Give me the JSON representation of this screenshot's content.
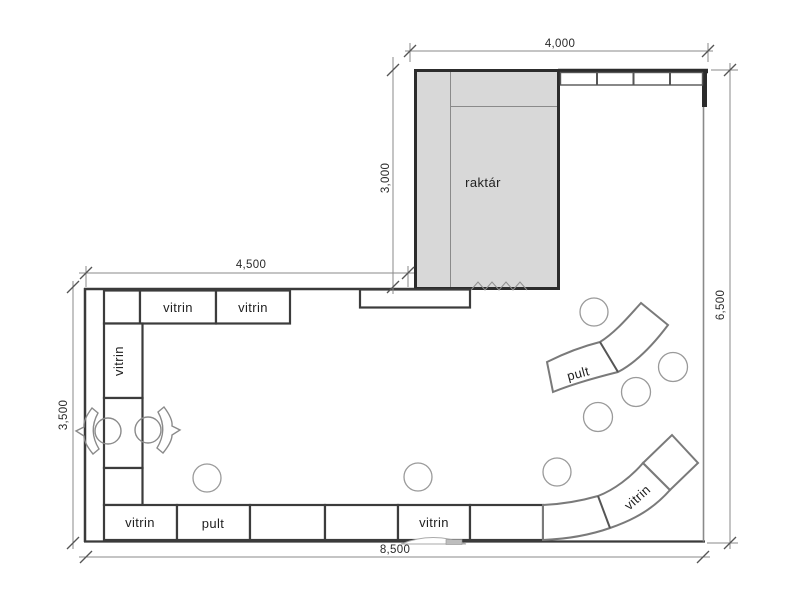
{
  "drawing": {
    "type": "shop-floor-plan",
    "rooms": {
      "storage": {
        "label": "raktár"
      }
    },
    "fixtures": {
      "top_row": [
        {
          "label": ""
        },
        {
          "label": "vitrin"
        },
        {
          "label": "vitrin"
        }
      ],
      "left_column": [
        {
          "label": "vitrin"
        },
        {
          "label": ""
        },
        {
          "label": ""
        }
      ],
      "bottom_row": [
        {
          "label": "vitrin"
        },
        {
          "label": "pult"
        },
        {
          "label": ""
        },
        {
          "label": ""
        },
        {
          "label": "vitrin"
        },
        {
          "label": ""
        }
      ],
      "curved_counter": {
        "label": "pult"
      },
      "curved_display": {
        "label": "vitrin"
      },
      "wall_shelf_segments": 4,
      "stool_count": 7,
      "armchair_count": 2
    },
    "dimensions": {
      "top_width": "4,000",
      "storage_depth": "3,000",
      "left_width": "4,500",
      "left_height": "3,500",
      "right_height": "6,500",
      "total_width": "8,500"
    },
    "colors": {
      "room_fill": "#d8d8d8",
      "wall": "#2c2c2c",
      "line": "#555555",
      "dim_line": "#8a8a8a",
      "text": "#1f1f1f"
    }
  }
}
